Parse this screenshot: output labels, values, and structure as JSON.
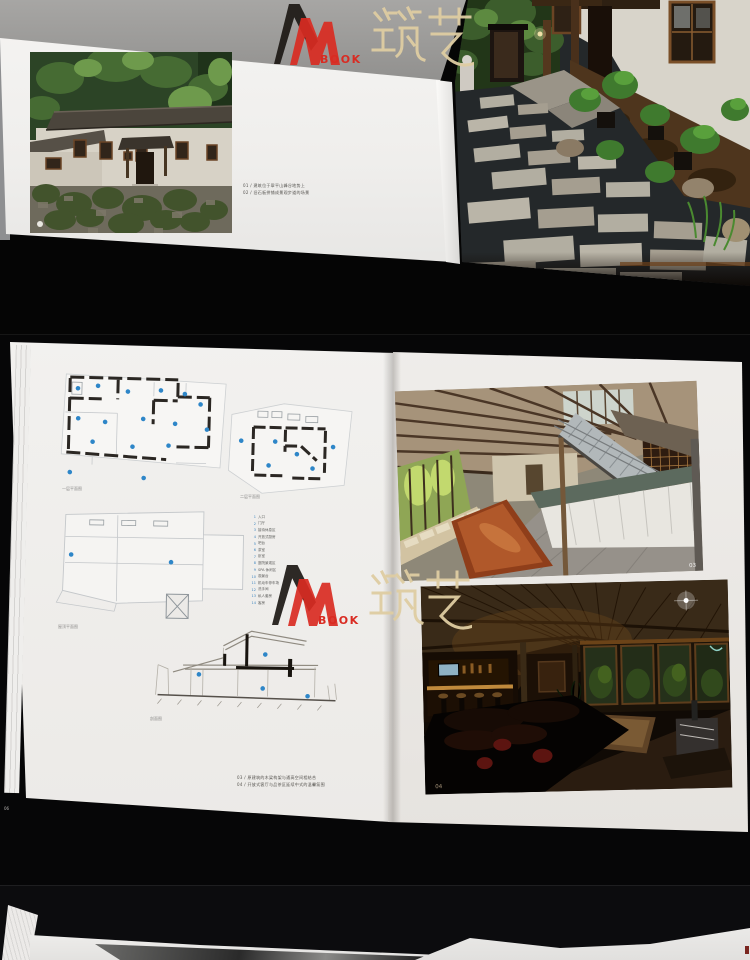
{
  "watermark": {
    "book_label": "BOOK",
    "cjk_label": "筑艺",
    "colors": {
      "peak_black": "#1c1814",
      "peak_red": "#d92b22",
      "cjk_tan": "#dfcda2"
    }
  },
  "spread1": {
    "captions": [
      "01 / 建筑位于翠平山峰谷地势上",
      "02 / 旧石板拼铺成景观步道的场景"
    ]
  },
  "spread2": {
    "plan_labels": {
      "floor1": "一层平面图",
      "floor2": "二层平面图",
      "roof": "屋顶平面图",
      "section": "剖面图"
    },
    "legend": [
      {
        "n": "1",
        "label": "入口"
      },
      {
        "n": "2",
        "label": "门厅"
      },
      {
        "n": "3",
        "label": "接待休息区"
      },
      {
        "n": "4",
        "label": "开放式厨房"
      },
      {
        "n": "5",
        "label": "吧台"
      },
      {
        "n": "6",
        "label": "茶室"
      },
      {
        "n": "7",
        "label": "卧室"
      },
      {
        "n": "8",
        "label": "庭院景观区"
      },
      {
        "n": "9",
        "label": "SPA 休闲区"
      },
      {
        "n": "10",
        "label": "观景台"
      },
      {
        "n": "11",
        "label": "机动车停车场"
      },
      {
        "n": "12",
        "label": "洗手间"
      },
      {
        "n": "13",
        "label": "私人套房"
      },
      {
        "n": "14",
        "label": "客房"
      }
    ],
    "captions": [
      "03 / 原建筑的木梁构架与通高空间相结合",
      "04 / 开放式客厅与品茶区延续中式的温馨氛围"
    ],
    "page_number": "06",
    "photo_numbers": {
      "top": "03",
      "bottom": "04"
    }
  },
  "colors": {
    "marker_blue": "#2e86c8",
    "page_white": "#f1f0ee",
    "table_black": "#050505"
  }
}
